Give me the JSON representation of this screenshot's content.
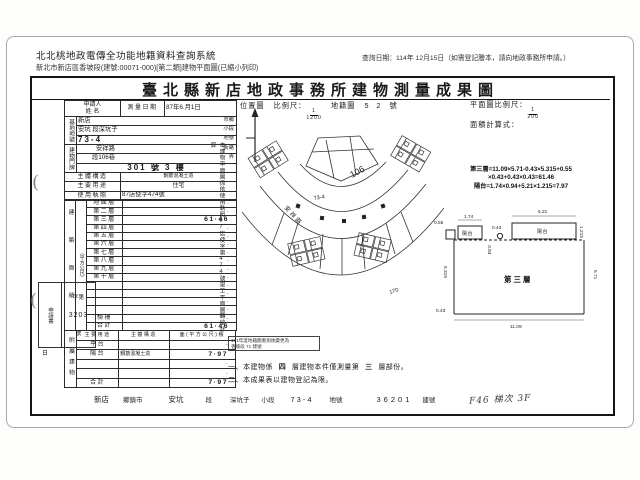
{
  "header": {
    "system_title": "北北桃地政電傳全功能地籍資料查詢系統",
    "query_date": "查詢日期：114年 12月15日（如需登記謄本，請向地政事務所申請。）",
    "subtitle": "新北市新店區香坡段(建號:00071-000)[第二類]建物平面圖(已縮小列印)"
  },
  "doc": {
    "title": "臺北縣新店地政事務所建物測量成果圖",
    "location_map": {
      "label": "位置圖",
      "scale_label": "比例尺：",
      "scale_num": "1",
      "scale_den": "1200",
      "sheet_label": "地籍圖",
      "sheet_no": "5 2",
      "sheet_unit": "號",
      "road_name": "安祥路",
      "lane_no": "106",
      "lot_no": "73-4",
      "outer_no": "170"
    },
    "plan": {
      "scale_label": "平面圖比例尺：",
      "scale_num": "1",
      "scale_den": "200",
      "formula_label": "面積計算式：",
      "calc_line1": "第三層=11.09×5.71-0.43×5.315+0.55",
      "calc_line2": "×0.43+0.43×0.43=61.46",
      "calc_line3": "陽台=1.74×0.94+5.21×1.215=7.97",
      "room_label": "第三層",
      "balcony_label_small": "陽台",
      "balcony_label_large": "陽台",
      "dims": {
        "notch_left": "0.55",
        "small_balcony_w": "1.74",
        "small_balcony_d": "0.94",
        "gap": "0.43",
        "large_balcony_w": "5.21",
        "large_balcony_d": "1.215",
        "left_h": "5.315",
        "right_h": "5.71",
        "bottom_w": "11.09",
        "bottom_notch": "0.43"
      }
    },
    "side_note": "本建物平面圖係依使用執照87店使字第474號竣工平面圖轉繪計算",
    "stamp_line1": "101年度地籍圖重測後變更為",
    "stamp_line2": "香坡段 71 建號",
    "note1_prefix": "一、本建物係",
    "note1_blank1": "四",
    "note1_mid": "層建物本件僅測量第",
    "note1_blank2": "三",
    "note1_suffix": "層部份。",
    "note2": "二、本成果表以建物登記為限。"
  },
  "form": {
    "applicant_label1": "申請人",
    "applicant_label2": "姓 名",
    "survey_date_label": "測量日期",
    "survey_date_value": "87年6.月1日",
    "site_label": "基地地號",
    "site_rows": [
      {
        "v": "新店",
        "u": "市鄉"
      },
      {
        "v": "安坑 段深坑子",
        "u": "小段"
      },
      {
        "v": "73-4",
        "u": "地號"
      }
    ],
    "addr_label": "建物門牌",
    "addr_rows": [
      {
        "v": "安祥路",
        "u": "街路"
      },
      {
        "v": "段106巷",
        "u": "弄"
      },
      {
        "v": "301 號 3 樓",
        "u": ""
      }
    ],
    "structure_label": "主體構造",
    "structure_value": "鋼筋混凝土造",
    "use_label": "主要用途",
    "use_value": "住宅",
    "license_label": "使用執照",
    "license_value": "87店使字474號",
    "area_label": "建築面積",
    "area_unit": "（平方公尺）",
    "floors": [
      {
        "label": "地面層",
        "value": "·"
      },
      {
        "label": "第二層",
        "value": "·"
      },
      {
        "label": "第三層",
        "value": "61·46"
      },
      {
        "label": "第四層",
        "value": "·"
      },
      {
        "label": "第五層",
        "value": "·"
      },
      {
        "label": "第六層",
        "value": "·"
      },
      {
        "label": "第七層",
        "value": "·"
      },
      {
        "label": "第八層",
        "value": "·"
      },
      {
        "label": "第九層",
        "value": "·"
      },
      {
        "label": "第十層",
        "value": "·"
      },
      {
        "label": "",
        "value": "·"
      },
      {
        "label": "",
        "value": "·"
      },
      {
        "label": "",
        "value": "·"
      },
      {
        "label": "",
        "value": "·"
      },
      {
        "label": "騎樓",
        "value": "·"
      },
      {
        "label": "合計",
        "value": "61·46"
      }
    ],
    "application_label": "申請書",
    "application_no_prefix": "字第",
    "application_no": "3203",
    "application_no_suffix": "號",
    "application_date_label": "日",
    "annex_label": "附屬建物",
    "annex_headers": [
      "主要用途",
      "主體構造",
      "面(平方公尺)積"
    ],
    "annex_rows": [
      {
        "u": "平台",
        "s": "",
        "a": "·"
      },
      {
        "u": "陽台",
        "s": "鋼筋混凝土造",
        "a": "7·97"
      },
      {
        "u": "",
        "s": "",
        "a": "·"
      },
      {
        "u": "",
        "s": "",
        "a": "·"
      },
      {
        "u": "合計",
        "s": "",
        "a": "7·97"
      }
    ]
  },
  "footer_strip": {
    "items": [
      {
        "v": "新店",
        "u": "鄉鎮市"
      },
      {
        "v": "安坑",
        "u": "段"
      },
      {
        "v": "深坑子",
        "u": "小段"
      },
      {
        "v": "73-4",
        "u": "地號"
      },
      {
        "v": "36201",
        "u": "建號"
      }
    ],
    "handwritten": "F46 梯次 3F"
  },
  "marks": {
    "paren1": "(",
    "paren2": "("
  }
}
